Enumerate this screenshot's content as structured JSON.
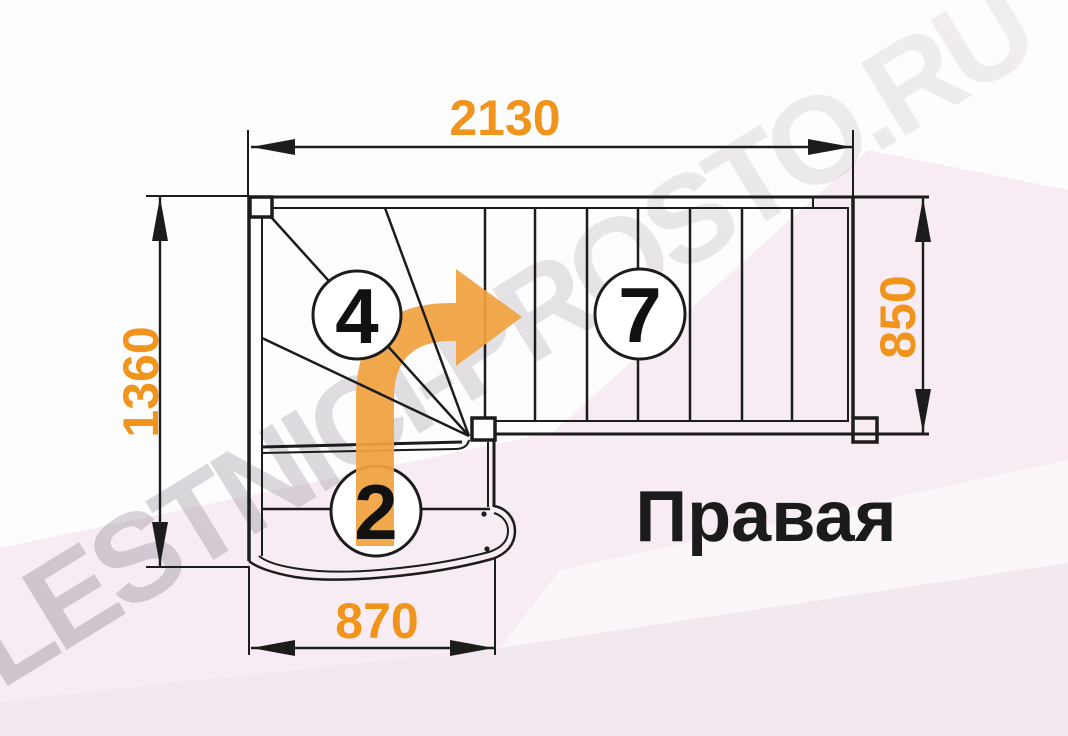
{
  "title": "Staircase floor-plan drawing, right-hand turn",
  "dimensions": {
    "top": "2130",
    "left": "1360",
    "right": "850",
    "bottom": "870"
  },
  "step_counts": {
    "winder_flight": "4",
    "upper_flight": "7",
    "lower_flight": "2"
  },
  "orientation_label": "Правая",
  "watermark": "LESTNICI-PROSTO.RU",
  "colors": {
    "accent_orange": "#F0941C",
    "arrow_orange": "#F1A340",
    "line_black": "#1C1C1C",
    "bg_pink": "#F7ECF3",
    "bg_white": "#FEFDFE"
  }
}
